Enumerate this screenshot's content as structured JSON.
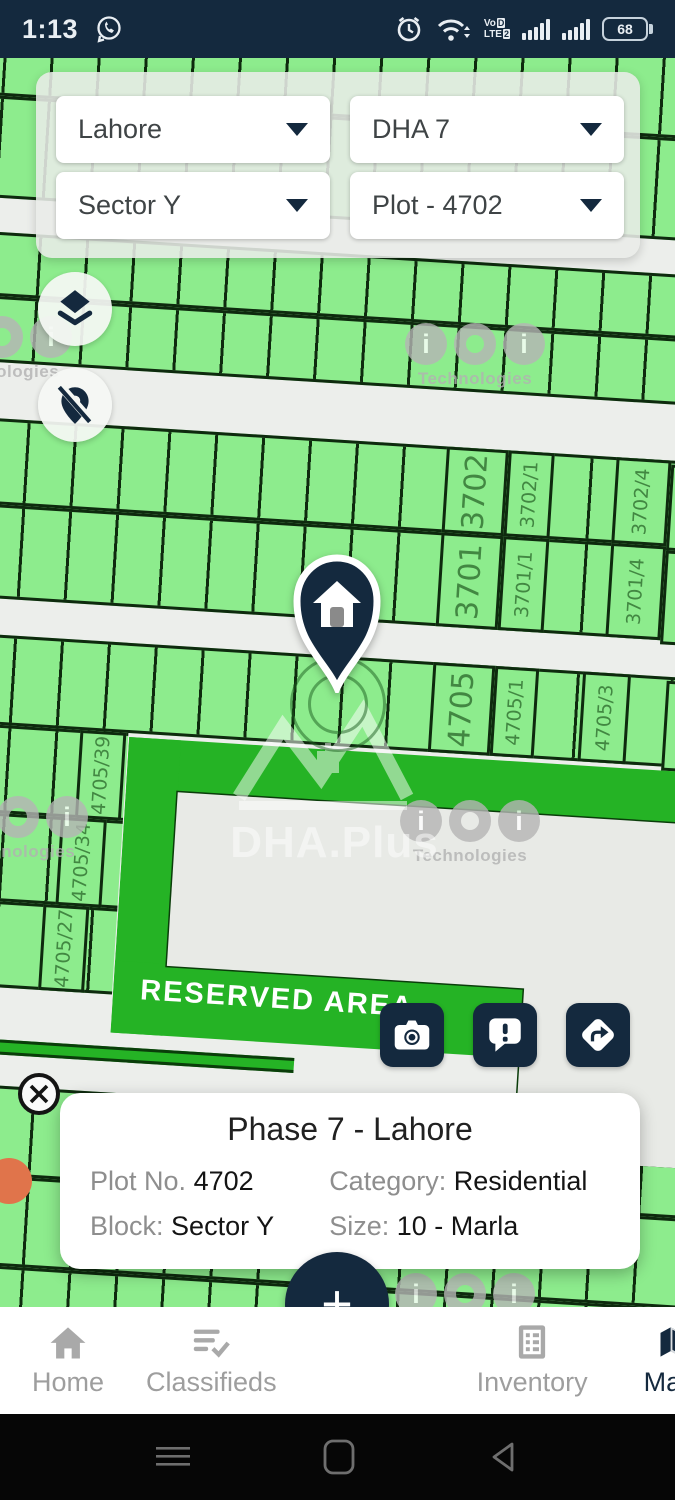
{
  "status_bar": {
    "time": "1:13",
    "battery_percent": "68",
    "volte": {
      "line1": "Vo",
      "badge1": "D",
      "line2": "LTE",
      "badge2": "2"
    }
  },
  "filters": {
    "city": "Lahore",
    "phase": "DHA 7",
    "sector": "Sector Y",
    "plot": "Plot - 4702"
  },
  "map": {
    "reserved_area_label": "RESERVED AREA",
    "watermark": {
      "brand": "DHA.Plus",
      "tech_name": "Technologies",
      "c1": "i",
      "c2": "o",
      "c3": "i"
    },
    "plots": {
      "p3702": "3702",
      "p3702_1": "3702/1",
      "p3702_4": "3702/4",
      "p4880": "4880",
      "p3701": "3701",
      "p3701_1": "3701/1",
      "p3701_4": "3701/4",
      "p4898": "4898",
      "p4705": "4705",
      "p4705_1": "4705/1",
      "p4705_3": "4705/3",
      "p4809": "4809",
      "p4705_39": "4705/39",
      "p4705_34": "4705/34",
      "p4705_27": "4705/27",
      "p3681": "3681",
      "p3673_1": "3673/1"
    }
  },
  "info_card": {
    "title": "Phase 7 - Lahore",
    "plot_label": "Plot No.",
    "plot_value": "4702",
    "category_label": "Category:",
    "category_value": "Residential",
    "block_label": "Block:",
    "block_value": "Sector Y",
    "size_label": "Size:",
    "size_value": "10 - Marla"
  },
  "fab_label": "+",
  "bottom_nav": {
    "home": "Home",
    "classifieds": "Classifieds",
    "inventory": "Inventory",
    "maps": "Maps"
  },
  "colors": {
    "navy": "#14293E",
    "plot_green": "#8DEC8D",
    "bright_green": "#25B325",
    "plot_border": "#0E2A0E",
    "road": "#ECEEEB",
    "label_green": "#42874B",
    "label_red": "#C04534"
  }
}
